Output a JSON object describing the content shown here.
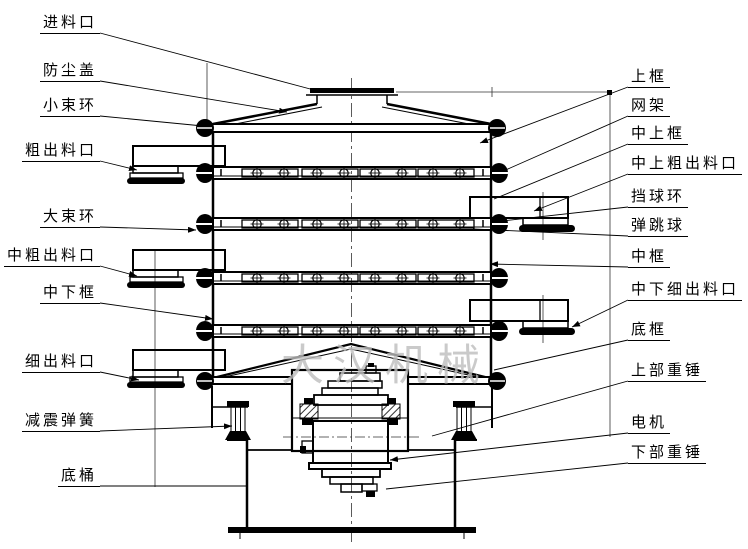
{
  "watermark": {
    "text": "大汉机械",
    "color": "#bdbdbd"
  },
  "labels": {
    "left": [
      {
        "id": "feed-inlet",
        "text": "进料口"
      },
      {
        "id": "dust-cover",
        "text": "防尘盖"
      },
      {
        "id": "small-clamp-ring",
        "text": "小束环"
      },
      {
        "id": "coarse-outlet",
        "text": "粗出料口"
      },
      {
        "id": "large-clamp-ring",
        "text": "大束环"
      },
      {
        "id": "mid-coarse-outlet",
        "text": "中粗出料口"
      },
      {
        "id": "mid-lower-frame",
        "text": "中下框"
      },
      {
        "id": "fine-outlet",
        "text": "细出料口"
      },
      {
        "id": "damping-spring",
        "text": "减震弹簧"
      },
      {
        "id": "base-barrel",
        "text": "底桶"
      }
    ],
    "right": [
      {
        "id": "upper-frame",
        "text": "上框"
      },
      {
        "id": "mesh-frame",
        "text": "网架"
      },
      {
        "id": "mid-upper-frame",
        "text": "中上框"
      },
      {
        "id": "mid-upper-coarse-outlet",
        "text": "中上粗出料口"
      },
      {
        "id": "ball-stop-ring",
        "text": "挡球环"
      },
      {
        "id": "bouncing-ball",
        "text": "弹跳球"
      },
      {
        "id": "middle-frame",
        "text": "中框"
      },
      {
        "id": "mid-lower-fine-outlet",
        "text": "中下细出料口"
      },
      {
        "id": "bottom-frame",
        "text": "底框"
      },
      {
        "id": "upper-weight",
        "text": "上部重锤"
      },
      {
        "id": "motor",
        "text": "电机"
      },
      {
        "id": "lower-weight",
        "text": "下部重锤"
      }
    ]
  },
  "colors": {
    "line": "#000000",
    "background": "#ffffff"
  }
}
